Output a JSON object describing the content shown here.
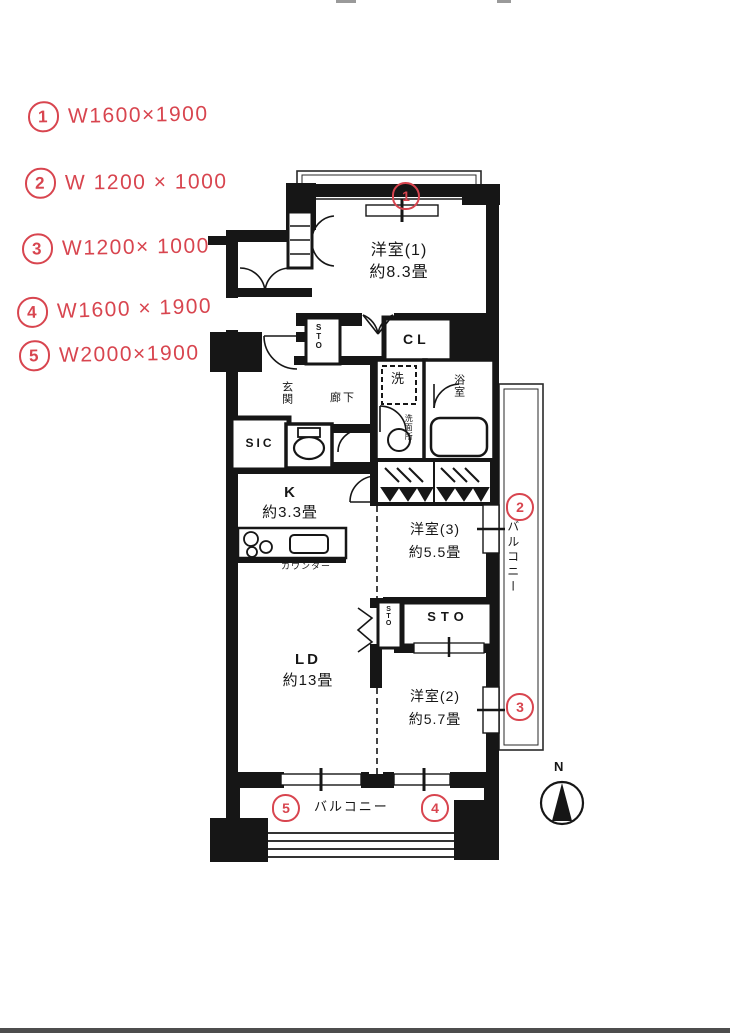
{
  "annotations": {
    "items": [
      {
        "num": "1",
        "text": "W1600×1900"
      },
      {
        "num": "2",
        "text": "W 1200 × 1000"
      },
      {
        "num": "3",
        "text": "W1200× 1000"
      },
      {
        "num": "4",
        "text": "W1600 × 1900"
      },
      {
        "num": "5",
        "text": "W2000×1900"
      }
    ]
  },
  "plan": {
    "rooms": {
      "yoshitsu1": {
        "name": "洋室(1)",
        "size": "約8.3畳"
      },
      "yoshitsu2": {
        "name": "洋室(2)",
        "size": "約5.7畳"
      },
      "yoshitsu3": {
        "name": "洋室(3)",
        "size": "約5.5畳"
      },
      "ld": {
        "name": "LD",
        "size": "約13畳"
      },
      "k": {
        "name": "K",
        "size": "約3.3畳"
      },
      "genkan": "玄関",
      "rouka": "廊下",
      "sic": "SIC",
      "cl": "CL",
      "sto_upper": "STO",
      "sto_small": "STO",
      "sto_main": "STO",
      "washer": "洗",
      "senmenjo": "洗面所",
      "bath": "浴室",
      "counter_label": "カウンター",
      "balcony_bottom": "バルコニー",
      "balcony_right": "バルコニー"
    },
    "markers": {
      "m1": "1",
      "m2": "2",
      "m3": "3",
      "m4": "4",
      "m5": "5"
    },
    "compass": {
      "north": "N"
    }
  },
  "colors": {
    "ink": "#161616",
    "annotation_red": "#d8454f"
  }
}
